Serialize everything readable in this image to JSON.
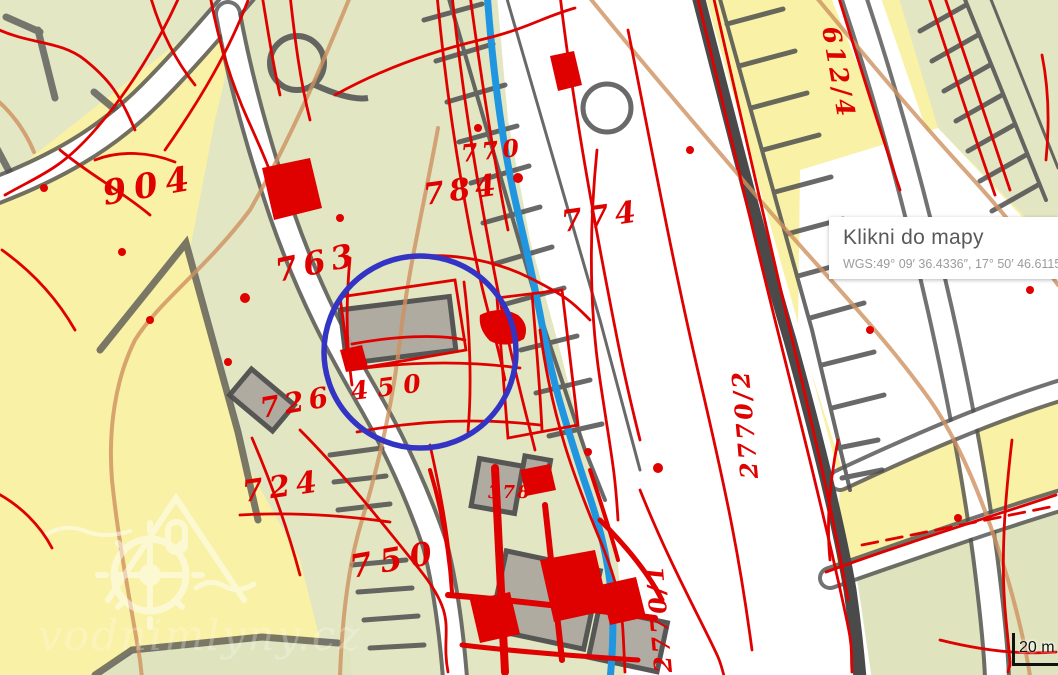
{
  "map": {
    "info_box": {
      "title": "Klikni do mapy",
      "coordinates": "WGS:49° 09′ 36.4336″, 17° 50′ 46.6115″"
    },
    "scale_bar": {
      "label": "20 m"
    },
    "watermark": {
      "site": "vodnimlyny.cz"
    },
    "parcel_labels": [
      {
        "text": "904"
      },
      {
        "text": "763"
      },
      {
        "text": "784"
      },
      {
        "text": "770"
      },
      {
        "text": "774"
      },
      {
        "text": "726"
      },
      {
        "text": "450"
      },
      {
        "text": "724"
      },
      {
        "text": "750"
      },
      {
        "text": "378"
      },
      {
        "text": "612/4"
      },
      {
        "text": "2770/2"
      },
      {
        "text": "2770/1"
      }
    ],
    "colors": {
      "field_yellow": "#F9F1A5",
      "field_green": "#E2E6C2",
      "road_white": "#FFFFFF",
      "road_casing": "#4F4F4F",
      "stream_blue": "#2196E0",
      "contour_orange": "#CE9160",
      "overlay_red": "#DF0000",
      "marker_blue": "#3434C4",
      "building_gray": "#ACA89F"
    }
  }
}
